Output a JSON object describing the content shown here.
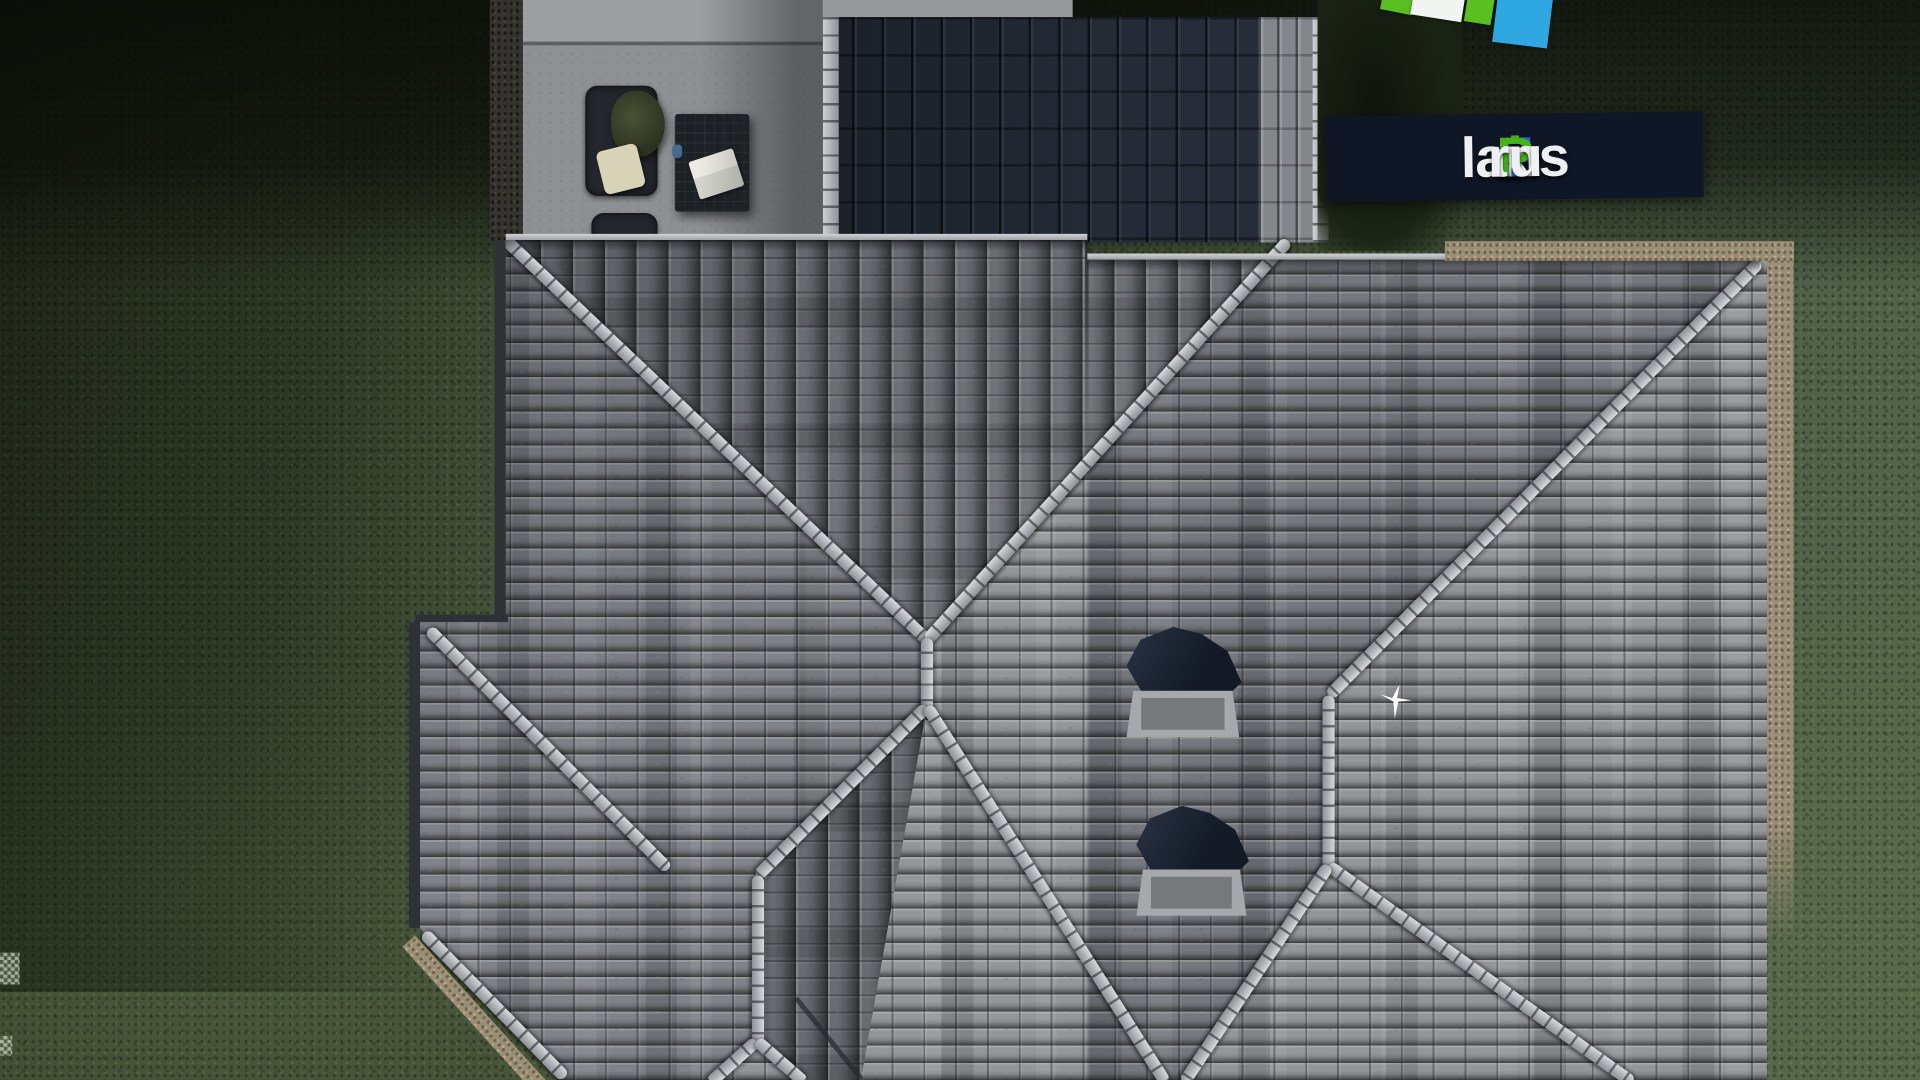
{
  "logo": {
    "banner_bg": "#0f1626",
    "segments": [
      {
        "text": "F",
        "color": "#2563cf"
      },
      {
        "text": "i",
        "color": "#45b31d"
      },
      {
        "text": "x",
        "color": "#eef0f3"
      },
      {
        "text": "P",
        "color": "#45b31d"
      },
      {
        "text": "lans",
        "color": "#eef0f3"
      },
      {
        "text": ".",
        "color": "#2563cf"
      },
      {
        "text": "ru",
        "color": "#eef0f3"
      }
    ],
    "mark_square_colors": [
      "#5abf21",
      "#f2f4f2",
      "#5abf21",
      "#2fa8e1"
    ]
  },
  "scene": {
    "type": "aerial-3d-architectural-render",
    "subject": "hip-roof house top view with lawn, terrace and watermark",
    "palette": {
      "grass": "#49563b",
      "grass_shadow": "#10150c",
      "roof_tile_light": "#94969a",
      "roof_tile_medium": "#7f8287",
      "roof_tile_dark": "#6a6d71",
      "roof_north_dark": "#20262f",
      "ridge_cap": "#c2c4c7",
      "gravel_edge": "#9b8f76",
      "patio_concrete": "#8e9093",
      "chimney_glass": "#131a26",
      "bird": "#ffffff"
    }
  }
}
